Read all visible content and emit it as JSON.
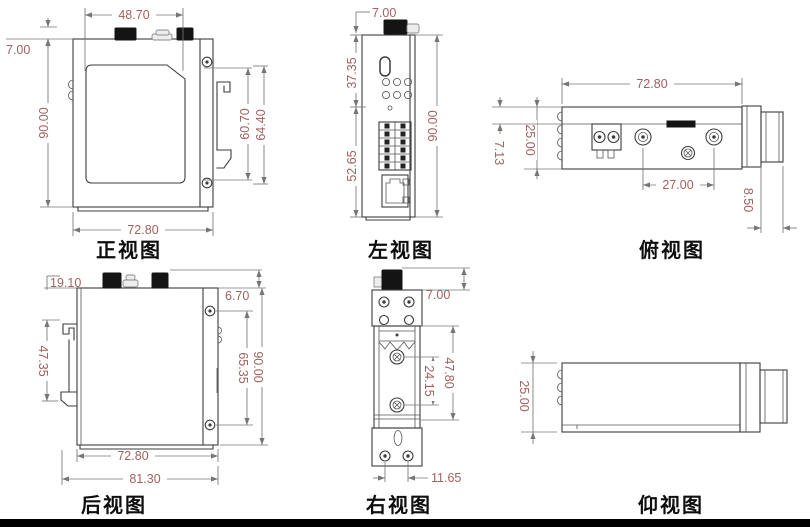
{
  "drawing": {
    "title": "six-view dimensioned drawing of DIN-rail industrial device",
    "colors": {
      "dim_text": "#a2615f",
      "outline": "#3d3d3d",
      "dim_line": "#767676",
      "caption": "#0e0e0e",
      "connector_fill": "#141414",
      "bottom_bar": "#000000"
    },
    "views": {
      "front": {
        "caption": "正视图",
        "dims": {
          "connector_span": "48.70",
          "antenna_height": "7.00",
          "body_height": "90.00",
          "clip_inner": "60.70",
          "clip_outer": "64.40",
          "body_width": "72.80"
        }
      },
      "left": {
        "caption": "左视图",
        "dims": {
          "antenna_height": "7.00",
          "upper_section": "37.35",
          "lower_section": "52.65",
          "body_height": "90.00"
        }
      },
      "top": {
        "caption": "俯视图",
        "dims": {
          "body_width": "72.80",
          "body_depth": "25.00",
          "edge_step": "7.13",
          "antenna_pitch": "27.00",
          "rail_depth": "8.50"
        }
      },
      "back": {
        "caption": "后视图",
        "dims": {
          "clip_offset": "19.10",
          "clip_length": "47.35",
          "antenna_height": "6.70",
          "screw_pitch": "65.35",
          "body_height": "90.00",
          "body_width": "72.80",
          "overall_width": "81.30"
        }
      },
      "right": {
        "caption": "右视图",
        "dims": {
          "antenna_height": "7.00",
          "screw_pitch": "24.15",
          "clip_window": "47.80",
          "foot_screw_pitch": "11.65"
        }
      },
      "bottom": {
        "caption": "仰视图",
        "dims": {
          "body_depth": "25.00"
        }
      }
    }
  }
}
